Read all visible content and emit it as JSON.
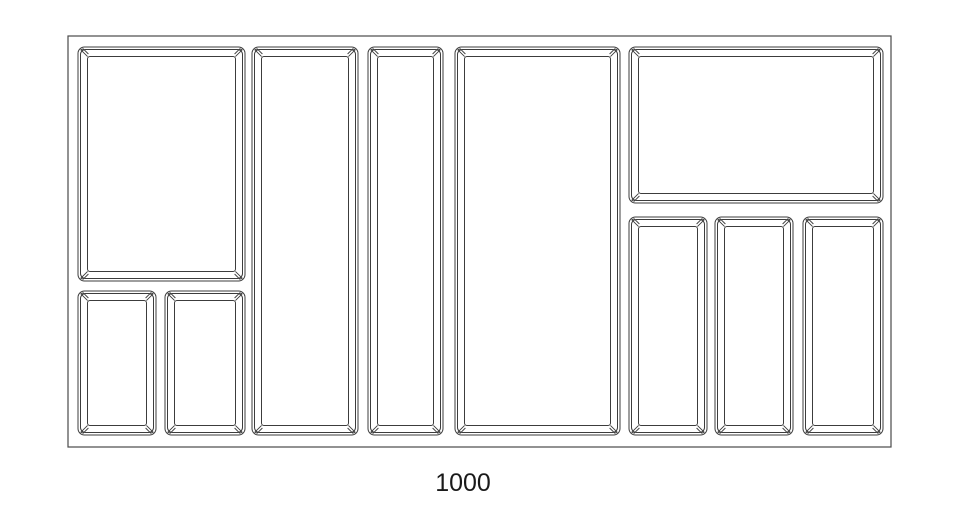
{
  "drawing": {
    "type": "technical-drawing",
    "subject": "cutlery-tray-insert-top-view",
    "dimension_label": "1000",
    "canvas": {
      "width": 960,
      "height": 527
    },
    "colors": {
      "background": "#ffffff",
      "line": "#3c3c3c",
      "outline_line": "#4a4a4a",
      "label_text": "#1a1a1a"
    },
    "tray_outline": {
      "x": 68,
      "y": 36,
      "width": 823,
      "height": 411
    },
    "compartment_style": {
      "rim_inset": 2.5,
      "wall_inset": 9.5,
      "outer_radius": 6.5,
      "rim_radius": 5,
      "inner_radius": 2.5,
      "corner_bevel_path": "M9.6,9.6 L2.8,2.8 L5.2,1.8 L10.4,7.0"
    },
    "compartments": [
      {
        "name": "top-left-large",
        "x": 78,
        "y": 47,
        "width": 167,
        "height": 234
      },
      {
        "name": "bottom-left-small-1",
        "x": 78,
        "y": 291,
        "width": 78,
        "height": 144
      },
      {
        "name": "bottom-left-small-2",
        "x": 165,
        "y": 291,
        "width": 80,
        "height": 144
      },
      {
        "name": "center-tall-1",
        "x": 252,
        "y": 47,
        "width": 106,
        "height": 388
      },
      {
        "name": "center-tall-2",
        "x": 368,
        "y": 47,
        "width": 75,
        "height": 388
      },
      {
        "name": "center-tall-3",
        "x": 455,
        "y": 47,
        "width": 165,
        "height": 388
      },
      {
        "name": "top-right-wide",
        "x": 629,
        "y": 47,
        "width": 254,
        "height": 156
      },
      {
        "name": "bottom-right-tall-1",
        "x": 629,
        "y": 217,
        "width": 78,
        "height": 218
      },
      {
        "name": "bottom-right-tall-2",
        "x": 715,
        "y": 217,
        "width": 78,
        "height": 218
      },
      {
        "name": "bottom-right-tall-3",
        "x": 803,
        "y": 217,
        "width": 80,
        "height": 218
      }
    ],
    "label_position": {
      "x": 463,
      "y": 491,
      "font_size": 25
    }
  }
}
